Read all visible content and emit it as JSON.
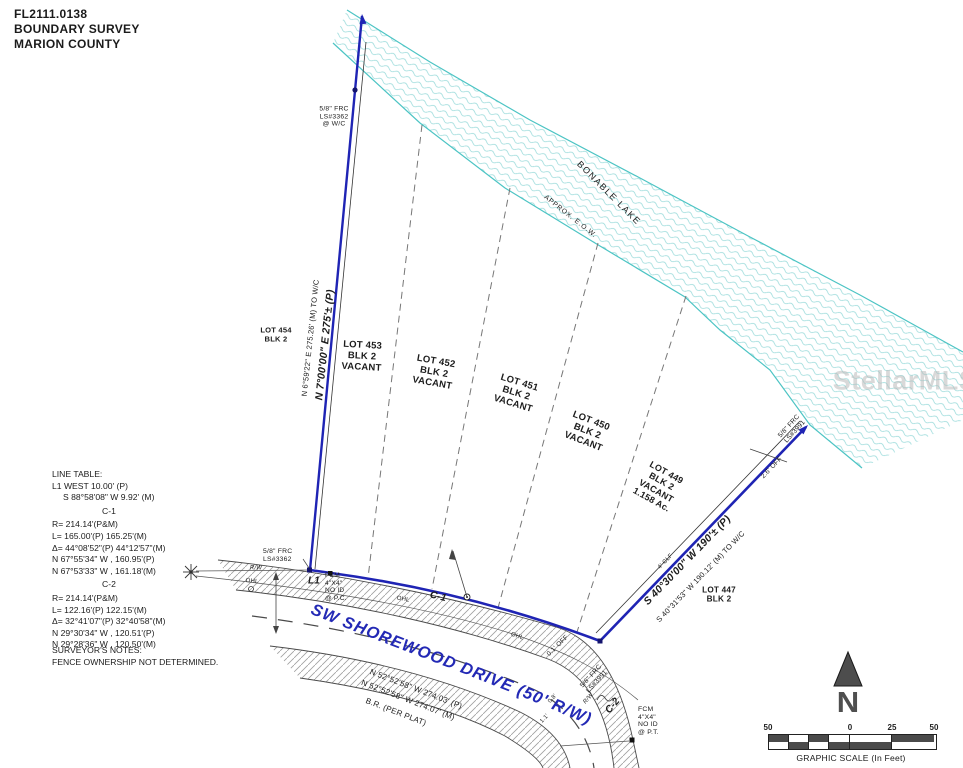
{
  "header": {
    "project": "FL2111.0138",
    "type": "BOUNDARY SURVEY",
    "county": "MARION COUNTY"
  },
  "watermark": "StellarMLS",
  "lake": {
    "name": "BONABLE LAKE",
    "edge": "APPROX. E.O.W."
  },
  "lots": [
    {
      "text": "LOT 454\nBLK 2"
    },
    {
      "text": "LOT 453\nBLK 2\nVACANT"
    },
    {
      "text": "LOT 452\nBLK 2\nVACANT"
    },
    {
      "text": "LOT 451\nBLK 2\nVACANT"
    },
    {
      "text": "LOT 450\nBLK 2\nVACANT"
    },
    {
      "text": "LOT 449\nBLK 2\nVACANT\n1.158 Ac."
    },
    {
      "text": "LOT 447\nBLK 2"
    }
  ],
  "bearings": {
    "west_line_plat": "N 7°00'00\" E  275'± (P)",
    "west_line_meas": "N 6°59'22\" E  275.26' (M) TO W/C",
    "east_line_plat": "S 40°30'00\" W  190'± (P)",
    "east_line_meas": "S 40°31'53\" W  190.12' (M) TO W/C",
    "road_plat": "N 52°52'58\" W  274.03' (P)",
    "road_meas": "N 52°52'58\" W  274.07' (M)",
    "road_br": "B.R. (PER PLAT)"
  },
  "road": {
    "name": "SW SHOREWOOD DRIVE (50' R/W)"
  },
  "markers": {
    "frc_top_left": "5/8\" FRC\nLS#3362\n@ W/C",
    "frc_bottom_left": "5/8\" FRC\nLS#3362",
    "fcm_pc": "FCM\n4\"X4\"\nNO ID\n@ P.C.",
    "fcm_pt": "FCM\n4\"X4\"\nNO ID\n@ P.T.",
    "frc_top_right": "5/8\" FRC\nLS#3991",
    "frc_bottom_right": "5/8\" FRC\nLS#3991"
  },
  "annotations": {
    "l1": "L1",
    "c1": "C-1",
    "c2": "C-2",
    "rw": "R/W",
    "ohl": "OHL",
    "clf": "4' CLF",
    "off_right_top": "2.6' OFF",
    "off_right_bottom": "0.1' OFF",
    "off_a": "0.8'",
    "off_b": "1.1'"
  },
  "line_table": {
    "title": "LINE TABLE:",
    "rows": [
      "L1  WEST  10.00' (P)",
      "S 88°58'08\" W  9.92' (M)",
      "C-1",
      "R=   214.14'(P&M)",
      "L=   165.00'(P) 165.25'(M)",
      "Δ=   44°08'52\"(P) 44°12'57\"(M)",
      "N 67°55'34\" W , 160.95'(P)",
      "N 67°53'33\" W , 161.18'(M)",
      "C-2",
      "R=   214.14'(P&M)",
      "L=   122.16'(P) 122.15'(M)",
      "Δ=   32°41'07\"(P) 32°40'58\"(M)",
      "N 29°30'34\" W , 120.51'(P)",
      "N 29°28'36\" W , 120.50'(M)"
    ]
  },
  "notes": {
    "title": "SURVEYOR'S NOTES:",
    "body": "FENCE OWNERSHIP NOT DETERMINED."
  },
  "compass": {
    "n": "N"
  },
  "scale": {
    "left": "50",
    "zero": "0",
    "mid": "25",
    "right": "50",
    "caption": "GRAPHIC SCALE (In Feet)"
  }
}
